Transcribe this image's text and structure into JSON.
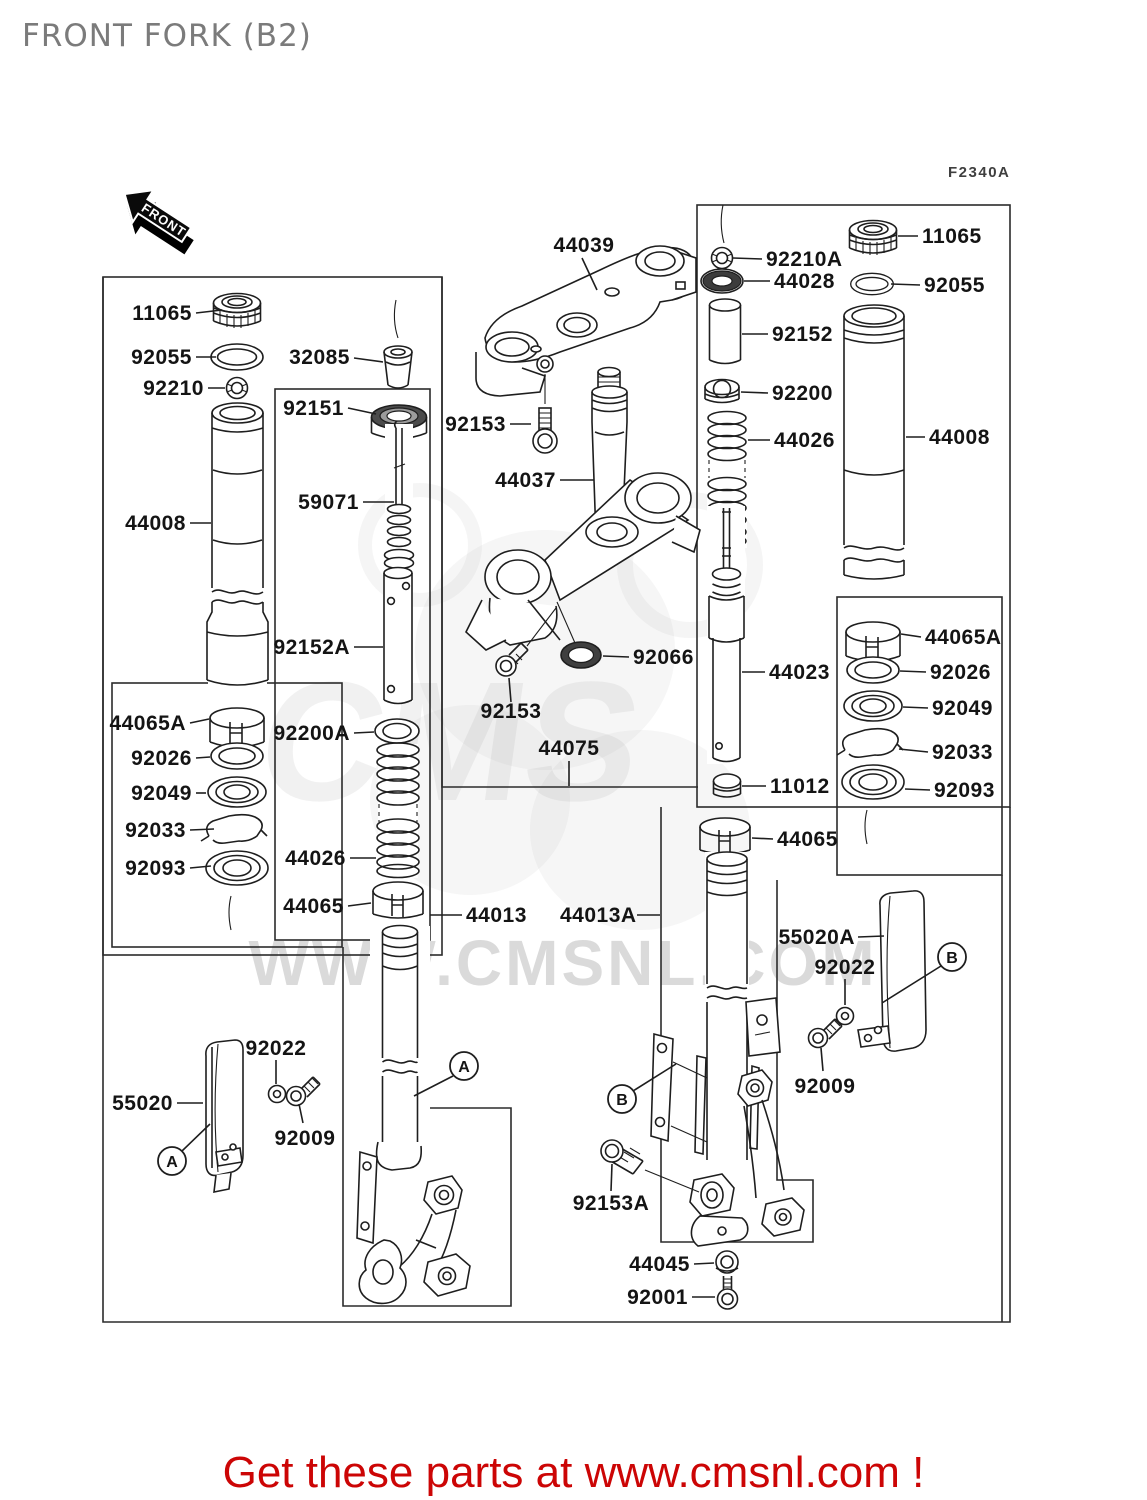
{
  "header": {
    "title": "FRONT FORK (B2)",
    "figure_code": "F2340A"
  },
  "front_arrow": {
    "label": "FRONT"
  },
  "watermark": {
    "text": "WWW.CMSNL.COM",
    "brand": "CMS"
  },
  "footer": {
    "text": "Get these parts at www.cmsnl.com !",
    "color": "#cc0505"
  },
  "colors": {
    "line": "#1e1e1e",
    "label": "#141414",
    "title": "#7b7b7b",
    "watermark": "#c2c2c2",
    "footer_red": "#cc0505"
  },
  "parts": [
    {
      "label": "11065",
      "x": 192,
      "y": 320,
      "anchor": "end",
      "leader": [
        196,
        313,
        222,
        310
      ]
    },
    {
      "label": "92055",
      "x": 192,
      "y": 364,
      "anchor": "end",
      "leader": [
        196,
        357,
        216,
        357
      ]
    },
    {
      "label": "92210",
      "x": 204,
      "y": 395,
      "anchor": "end",
      "leader": [
        208,
        388,
        225,
        388
      ]
    },
    {
      "label": "44008",
      "x": 186,
      "y": 530,
      "anchor": "end",
      "leader": [
        190,
        523,
        211,
        523
      ]
    },
    {
      "label": "32085",
      "x": 350,
      "y": 364,
      "anchor": "end",
      "leader": [
        354,
        358,
        383,
        362
      ]
    },
    {
      "label": "92151",
      "x": 344,
      "y": 415,
      "anchor": "end",
      "leader": [
        348,
        408,
        376,
        414
      ]
    },
    {
      "label": "59071",
      "x": 359,
      "y": 509,
      "anchor": "end",
      "leader": [
        363,
        502,
        394,
        502
      ]
    },
    {
      "label": "92152A",
      "x": 350,
      "y": 654,
      "anchor": "end",
      "leader": [
        354,
        647,
        383,
        647
      ]
    },
    {
      "label": "92200A",
      "x": 350,
      "y": 740,
      "anchor": "end",
      "leader": [
        354,
        733,
        374,
        732
      ]
    },
    {
      "label": "44026",
      "x": 346,
      "y": 865,
      "anchor": "end",
      "leader": [
        350,
        858,
        376,
        858
      ]
    },
    {
      "label": "44065",
      "x": 344,
      "y": 913,
      "anchor": "end",
      "leader": [
        348,
        906,
        371,
        903
      ]
    },
    {
      "label": "44065A",
      "x": 186,
      "y": 730,
      "anchor": "end",
      "leader": [
        190,
        723,
        209,
        719
      ]
    },
    {
      "label": "92026",
      "x": 192,
      "y": 765,
      "anchor": "end",
      "leader": [
        196,
        758,
        210,
        757
      ]
    },
    {
      "label": "92049",
      "x": 192,
      "y": 800,
      "anchor": "end",
      "leader": [
        196,
        793,
        206,
        793
      ]
    },
    {
      "label": "92033",
      "x": 186,
      "y": 837,
      "anchor": "end",
      "leader": [
        190,
        830,
        214,
        829
      ]
    },
    {
      "label": "92093",
      "x": 186,
      "y": 875,
      "anchor": "end",
      "leader": [
        190,
        868,
        211,
        866
      ]
    },
    {
      "label": "44039",
      "x": 584,
      "y": 252,
      "anchor": "middle",
      "leader": [
        582,
        258,
        597,
        290
      ]
    },
    {
      "label": "92153",
      "x": 506,
      "y": 431,
      "anchor": "end",
      "leader": [
        510,
        424,
        531,
        424
      ]
    },
    {
      "label": "44037",
      "x": 556,
      "y": 487,
      "anchor": "end",
      "leader": [
        560,
        480,
        594,
        480
      ]
    },
    {
      "label": "92066",
      "x": 633,
      "y": 664,
      "anchor": "start",
      "leader": [
        629,
        657,
        603,
        656
      ]
    },
    {
      "label": "92153",
      "x": 511,
      "y": 718,
      "anchor": "middle",
      "leader": [
        511,
        702,
        509,
        678
      ]
    },
    {
      "label": "44075",
      "x": 569,
      "y": 755,
      "anchor": "middle",
      "leader": [
        569,
        761,
        569,
        786
      ]
    },
    {
      "label": "44013",
      "x": 466,
      "y": 922,
      "anchor": "start",
      "leader": [
        462,
        915,
        430,
        915
      ]
    },
    {
      "label": "44013A",
      "x": 560,
      "y": 922,
      "anchor": "start",
      "leader": [
        637,
        915,
        660,
        915
      ]
    },
    {
      "label": "92210A",
      "x": 766,
      "y": 266,
      "anchor": "start",
      "leader": [
        762,
        259,
        733,
        258
      ]
    },
    {
      "label": "44028",
      "x": 774,
      "y": 288,
      "anchor": "start",
      "leader": [
        770,
        281,
        744,
        281
      ]
    },
    {
      "label": "92152",
      "x": 772,
      "y": 341,
      "anchor": "start",
      "leader": [
        768,
        334,
        742,
        334
      ]
    },
    {
      "label": "92200",
      "x": 772,
      "y": 400,
      "anchor": "start",
      "leader": [
        768,
        393,
        741,
        392
      ]
    },
    {
      "label": "44026",
      "x": 774,
      "y": 447,
      "anchor": "start",
      "leader": [
        770,
        440,
        748,
        440
      ]
    },
    {
      "label": "11065",
      "x": 922,
      "y": 243,
      "anchor": "start",
      "leader": [
        918,
        236,
        898,
        236
      ]
    },
    {
      "label": "92055",
      "x": 924,
      "y": 292,
      "anchor": "start",
      "leader": [
        920,
        285,
        891,
        284
      ]
    },
    {
      "label": "44008",
      "x": 929,
      "y": 444,
      "anchor": "start",
      "leader": [
        925,
        437,
        906,
        437
      ]
    },
    {
      "label": "44023",
      "x": 769,
      "y": 679,
      "anchor": "start",
      "leader": [
        765,
        672,
        742,
        672
      ]
    },
    {
      "label": "11012",
      "x": 770,
      "y": 793,
      "anchor": "start",
      "leader": [
        766,
        786,
        742,
        786
      ]
    },
    {
      "label": "44065",
      "x": 777,
      "y": 846,
      "anchor": "start",
      "leader": [
        773,
        839,
        752,
        838
      ]
    },
    {
      "label": "44065A",
      "x": 925,
      "y": 644,
      "anchor": "start",
      "leader": [
        921,
        637,
        901,
        634
      ]
    },
    {
      "label": "92026",
      "x": 930,
      "y": 679,
      "anchor": "start",
      "leader": [
        926,
        672,
        900,
        671
      ]
    },
    {
      "label": "92049",
      "x": 932,
      "y": 715,
      "anchor": "start",
      "leader": [
        928,
        708,
        903,
        707
      ]
    },
    {
      "label": "92033",
      "x": 932,
      "y": 759,
      "anchor": "start",
      "leader": [
        928,
        752,
        899,
        749
      ]
    },
    {
      "label": "92093",
      "x": 934,
      "y": 797,
      "anchor": "start",
      "leader": [
        930,
        790,
        905,
        789
      ]
    },
    {
      "label": "55020A",
      "x": 855,
      "y": 944,
      "anchor": "end",
      "leader": [
        858,
        937,
        884,
        936
      ]
    },
    {
      "label": "92022",
      "x": 845,
      "y": 974,
      "anchor": "middle",
      "leader": [
        845,
        979,
        845,
        1005
      ]
    },
    {
      "label": "92009",
      "x": 825,
      "y": 1093,
      "anchor": "middle",
      "leader": [
        823,
        1071,
        821,
        1048
      ]
    },
    {
      "label": "55020",
      "x": 173,
      "y": 1110,
      "anchor": "end",
      "leader": [
        177,
        1103,
        203,
        1103
      ]
    },
    {
      "label": "92022",
      "x": 276,
      "y": 1055,
      "anchor": "middle",
      "leader": [
        276,
        1060,
        276,
        1084
      ]
    },
    {
      "label": "92009",
      "x": 305,
      "y": 1145,
      "anchor": "middle",
      "leader": [
        303,
        1123,
        299,
        1104
      ]
    },
    {
      "label": "92153A",
      "x": 611,
      "y": 1210,
      "anchor": "middle",
      "leader": [
        611,
        1191,
        612,
        1164
      ]
    },
    {
      "label": "44045",
      "x": 690,
      "y": 1271,
      "anchor": "end",
      "leader": [
        694,
        1264,
        714,
        1263
      ]
    },
    {
      "label": "92001",
      "x": 688,
      "y": 1304,
      "anchor": "end",
      "leader": [
        692,
        1297,
        715,
        1297
      ]
    }
  ],
  "callouts": [
    {
      "letter": "A",
      "cx": 172,
      "cy": 1161,
      "leader": [
        182,
        1151,
        210,
        1124
      ]
    },
    {
      "letter": "A",
      "cx": 464,
      "cy": 1066,
      "leader": [
        453,
        1076,
        414,
        1096
      ]
    },
    {
      "letter": "B",
      "cx": 952,
      "cy": 957,
      "leader": [
        941,
        966,
        882,
        1003
      ]
    },
    {
      "letter": "B",
      "cx": 622,
      "cy": 1099,
      "leader": [
        633,
        1091,
        676,
        1064
      ]
    }
  ]
}
